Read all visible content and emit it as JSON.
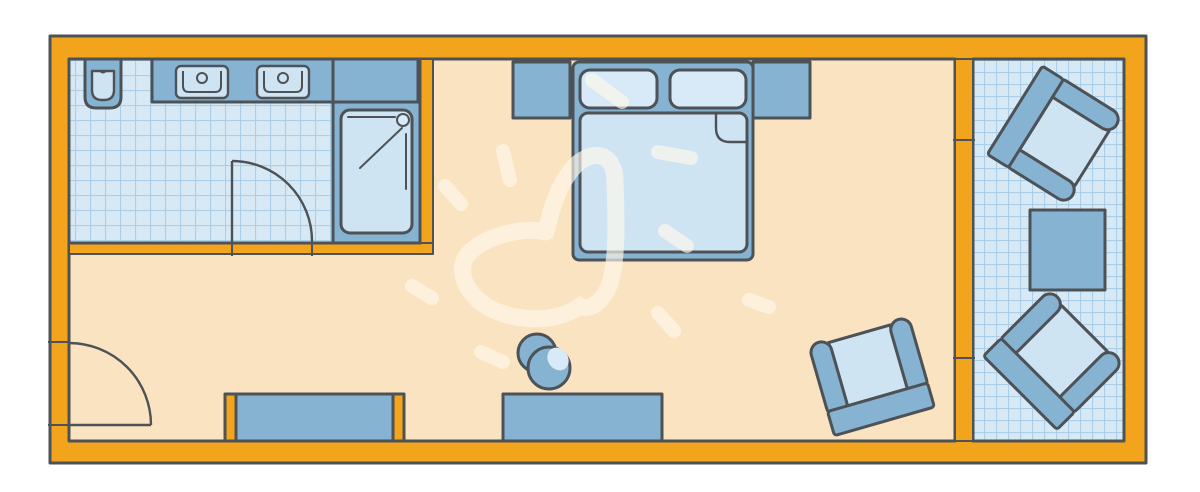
{
  "plan": {
    "kind": "hotel-room-floor-plan",
    "objects": [
      "bathroom with wall toilet, double vanity and shower",
      "bathroom swing door",
      "entrance swing door",
      "double bed with two pillows, folded blanket corner and two nightstands",
      "wardrobe and sideboard along bottom wall",
      "round stool",
      "armchair in room",
      "balcony with two armchairs and square table",
      "hand-drawn heart doodle with rays"
    ]
  },
  "colors": {
    "background": "#ffffff",
    "wall": "#f3a41d",
    "outline": "#4d5257",
    "floor": "#fae3c1",
    "tile_bg": "#d8e9f6",
    "tile_line": "#abcfe8",
    "furniture_blue": "#87b3d3",
    "upholstery_light": "#d8eaf7",
    "mattress_light": "#cfe4f3",
    "doodle": "#fff8ec"
  }
}
